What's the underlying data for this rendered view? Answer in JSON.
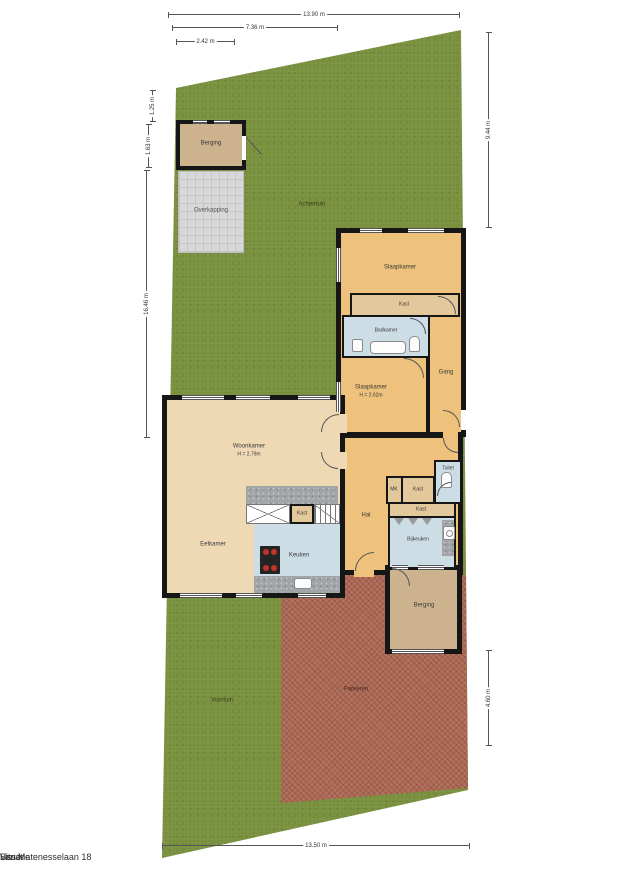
{
  "title": {
    "doc_type": "Situatie",
    "address": "Van Matenesselaan 18",
    "city": "Lisse"
  },
  "outdoor": {
    "achtertuin": "Achtertuin",
    "voortuin": "Voortuin",
    "parkeren": "Parkeren",
    "overkapping": "Overkapping",
    "berging_shed": "Berging"
  },
  "rooms": {
    "slaapkamer_1": "Slaapkamer",
    "kast_1": "Kast",
    "badkamer": "Badkamer",
    "slaapkamer_2": "Slaapkamer",
    "slaapkamer_2_height": "H = 2.62m",
    "gang": "Gang",
    "woonkamer": "Woonkamer",
    "woonkamer_height": "H = 2.79m",
    "eetkamer": "Eetkamer",
    "keuken": "Keuken",
    "kast_2": "Kast",
    "hal": "Hal",
    "mk": "MK",
    "kast_3": "Kast",
    "kast_4": "Kast",
    "toilet": "Toilet",
    "bijkeuken": "Bijkeuken",
    "berging": "Berging"
  },
  "dimensions": {
    "top_total": "13.90 m",
    "top_mid": "7.36 m",
    "top_small": "2.42 m",
    "left_top": "1.25 m",
    "left_mid": "1.63 m",
    "left_total": "16.46 m",
    "right_top": "9.44 m",
    "right_bottom": "4.60 m",
    "bottom_total": "13.50 m"
  },
  "colors": {
    "grass": "#79903e",
    "brick": "#b3705d",
    "room_orange": "#eec17c",
    "room_cream": "#eed9b4",
    "room_tan": "#cdb28e",
    "room_blue": "#cddde5",
    "wall": "#161616"
  }
}
